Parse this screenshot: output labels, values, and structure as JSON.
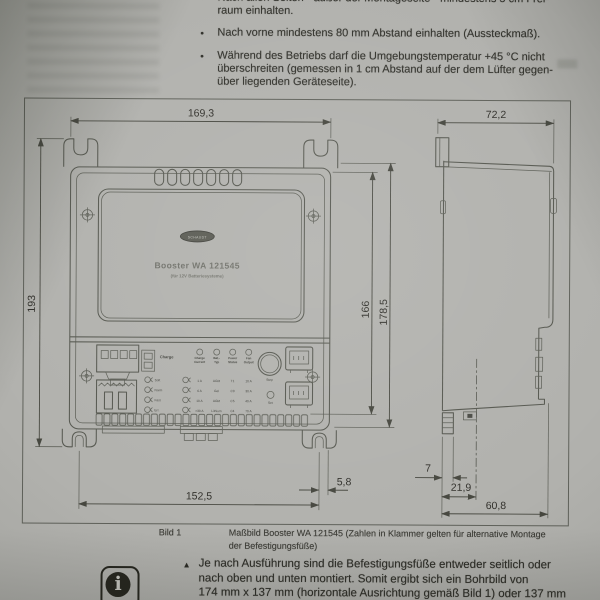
{
  "notes": {
    "bullet": "•",
    "items": [
      {
        "lines": [
          "Nach allen Seiten - außer der Montageseite - mindestens 5 cm Frei-",
          "raum einhalten."
        ]
      },
      {
        "lines": [
          "Nach vorne mindestens 80 mm Abstand einhalten (Aussteckmaß)."
        ]
      },
      {
        "lines": [
          "Während des Betriebs darf die Umgebungstemperatur +45 °C nicht",
          "überschreiten (gemessen in 1 cm Abstand auf der dem Lüfter gegen-",
          "über liegenden Geräteseite)."
        ]
      }
    ]
  },
  "device": {
    "brand": "SCHAUDT",
    "model": "Booster WA 121545",
    "subtitle": "(für 12V Batteriesysteme)"
  },
  "dims": {
    "front_width": "169,3",
    "overall_height": "193",
    "inner_height": "166",
    "outer_height": "178,5",
    "foot_spacing": "152,5",
    "foot_edge_offset": "5,8",
    "side_depth": "72,2",
    "side_foot_width": "7",
    "side_foot_center": "21,9",
    "side_bottom_depth": "60,8"
  },
  "panel": {
    "charge_label": "Charge",
    "charge_states": [
      "Soft",
      "Norm",
      "Fast",
      "Err."
    ],
    "led_headers": [
      [
        "Charge",
        "Current"
      ],
      [
        "Bat.-",
        "Typ"
      ],
      [
        "Power",
        "Status"
      ],
      [
        "Fan",
        "Output"
      ]
    ],
    "values": [
      [
        "1 A",
        "AGM",
        "T1",
        "10 A"
      ],
      [
        "6 A",
        "Gel",
        "C3",
        "30 A"
      ],
      [
        "10 A",
        "AGM",
        "C5",
        "40 A"
      ],
      [
        ">30 A",
        "Lithium",
        "C4",
        "70 A"
      ]
    ],
    "button_label": "Step",
    "aux_led_label": "Set"
  },
  "caption": {
    "figure_label": "Bild 1",
    "lines": [
      "Maßbild Booster WA 121545 (Zahlen in Klammer gelten für alternative Montage",
      "der Befestigungsfüße)"
    ]
  },
  "info_note": {
    "glyph": "i",
    "marker": "▲",
    "lines": [
      "Je nach Ausführung sind die Befestigungsfüße entweder seitlich oder",
      "nach oben und unten montiert. Somit ergibt sich ein Bohrbild von",
      "174 mm x 137 mm (horizontale Ausrichtung gemäß Bild 1) oder 137 mm"
    ]
  }
}
